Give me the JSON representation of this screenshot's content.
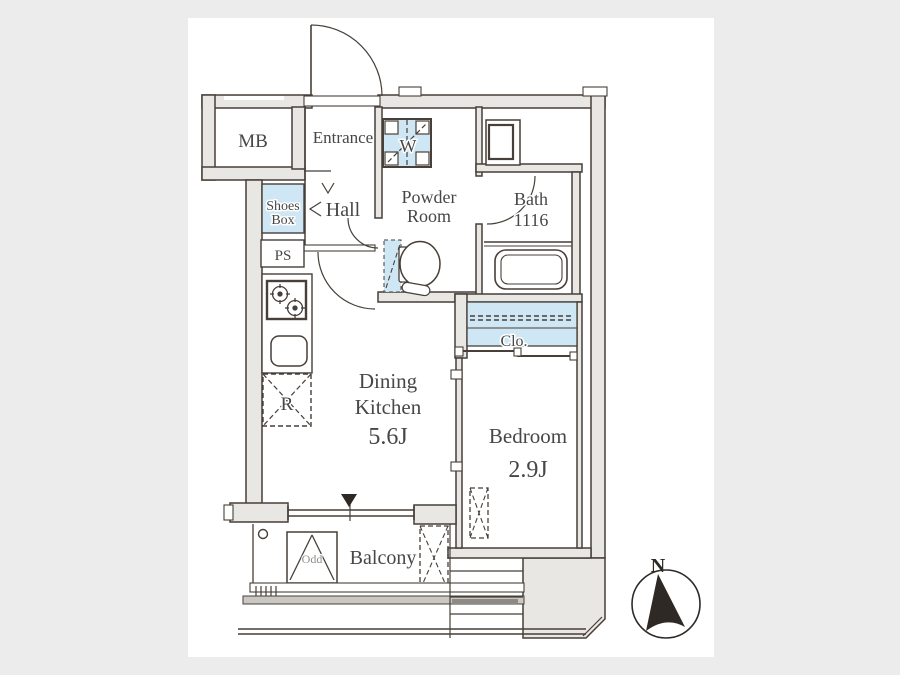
{
  "plan_type": "apartment-floor-plan",
  "labels": {
    "mb": "MB",
    "entrance": "Entrance",
    "shoes_box": [
      "Shoes",
      "Box"
    ],
    "hall": "Hall",
    "ps": "PS",
    "washer": "W",
    "powder_room": [
      "Powder",
      "Room"
    ],
    "bath": [
      "Bath",
      "1116"
    ],
    "closet": "Clo.",
    "dining_kitchen": [
      "Dining",
      "Kitchen",
      "5.6J"
    ],
    "bedroom": [
      "Bedroom",
      "2.9J"
    ],
    "refrigerator": "R",
    "balcony": "Balcony",
    "balcony_hatch": "Odd",
    "compass_north": "N"
  },
  "rooms_summary": [
    {
      "name": "Dining Kitchen",
      "size": "5.6J"
    },
    {
      "name": "Bedroom",
      "size": "2.9J"
    },
    {
      "name": "Bath",
      "size": "1116"
    }
  ],
  "colors": {
    "background": "#ececec",
    "paper": "#ffffff",
    "wall_fill": "#e9e7e4",
    "line": "#473f38",
    "fixture_blue": "#cfe7f5",
    "text": "#474747"
  }
}
